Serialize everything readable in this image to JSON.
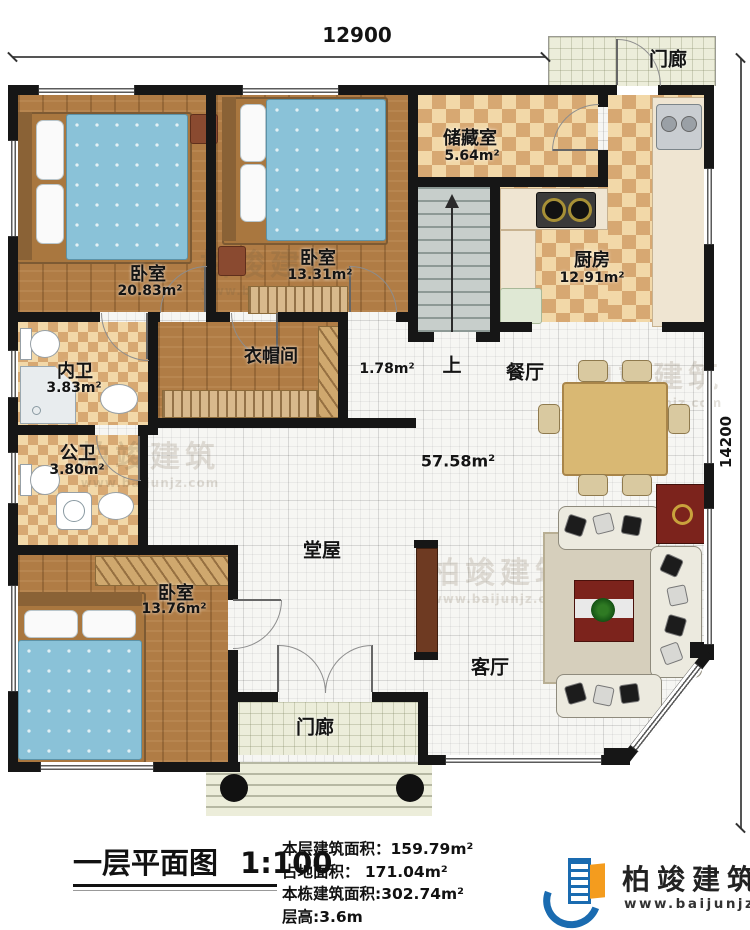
{
  "dims": {
    "top": "12900",
    "right": "14200"
  },
  "plan": {
    "porch_top": {
      "name": "门廊"
    },
    "storage": {
      "name": "储藏室",
      "area": "5.64m²"
    },
    "kitchen": {
      "name": "厨房",
      "area": "12.91m²"
    },
    "bedroom1": {
      "name": "卧室",
      "area": "20.83m²"
    },
    "bedroom2": {
      "name": "卧室",
      "area": "13.31m²"
    },
    "inner_bath": {
      "name": "内卫",
      "area": "3.83m²"
    },
    "cloakroom": {
      "name": "衣帽间"
    },
    "closet": {
      "area": "1.78m²"
    },
    "stairs": {
      "up": "上"
    },
    "dining": {
      "name": "餐厅"
    },
    "public_bath": {
      "name": "公卫",
      "area": "3.80m²"
    },
    "hall": {
      "name": "堂屋",
      "area": "57.58m²"
    },
    "bedroom3": {
      "name": "卧室",
      "area": "13.76m²"
    },
    "living": {
      "name": "客厅"
    },
    "porch_bottom": {
      "name": "门廊"
    }
  },
  "title_block": {
    "title": "一层平面图",
    "scale": "1:100",
    "stats": [
      "本层建筑面积：159.79m²",
      "占地面积： 171.04m²",
      "本栋建筑面积:302.74m²",
      "层高:3.6m"
    ]
  },
  "brand": {
    "company": "柏竣建筑",
    "site": "www.baijunjz.com"
  },
  "watermark": {
    "text": "柏竣建筑",
    "site": "www.baijunjz.com"
  },
  "colors": {
    "wall": "#161616",
    "wood": "#b07c45",
    "checker_dark": "#d7a872",
    "checker_light": "#f2d8a8",
    "logo_blue": "#1a6bb0",
    "logo_orange": "#f49c1e",
    "accent_red": "#7c231c"
  }
}
